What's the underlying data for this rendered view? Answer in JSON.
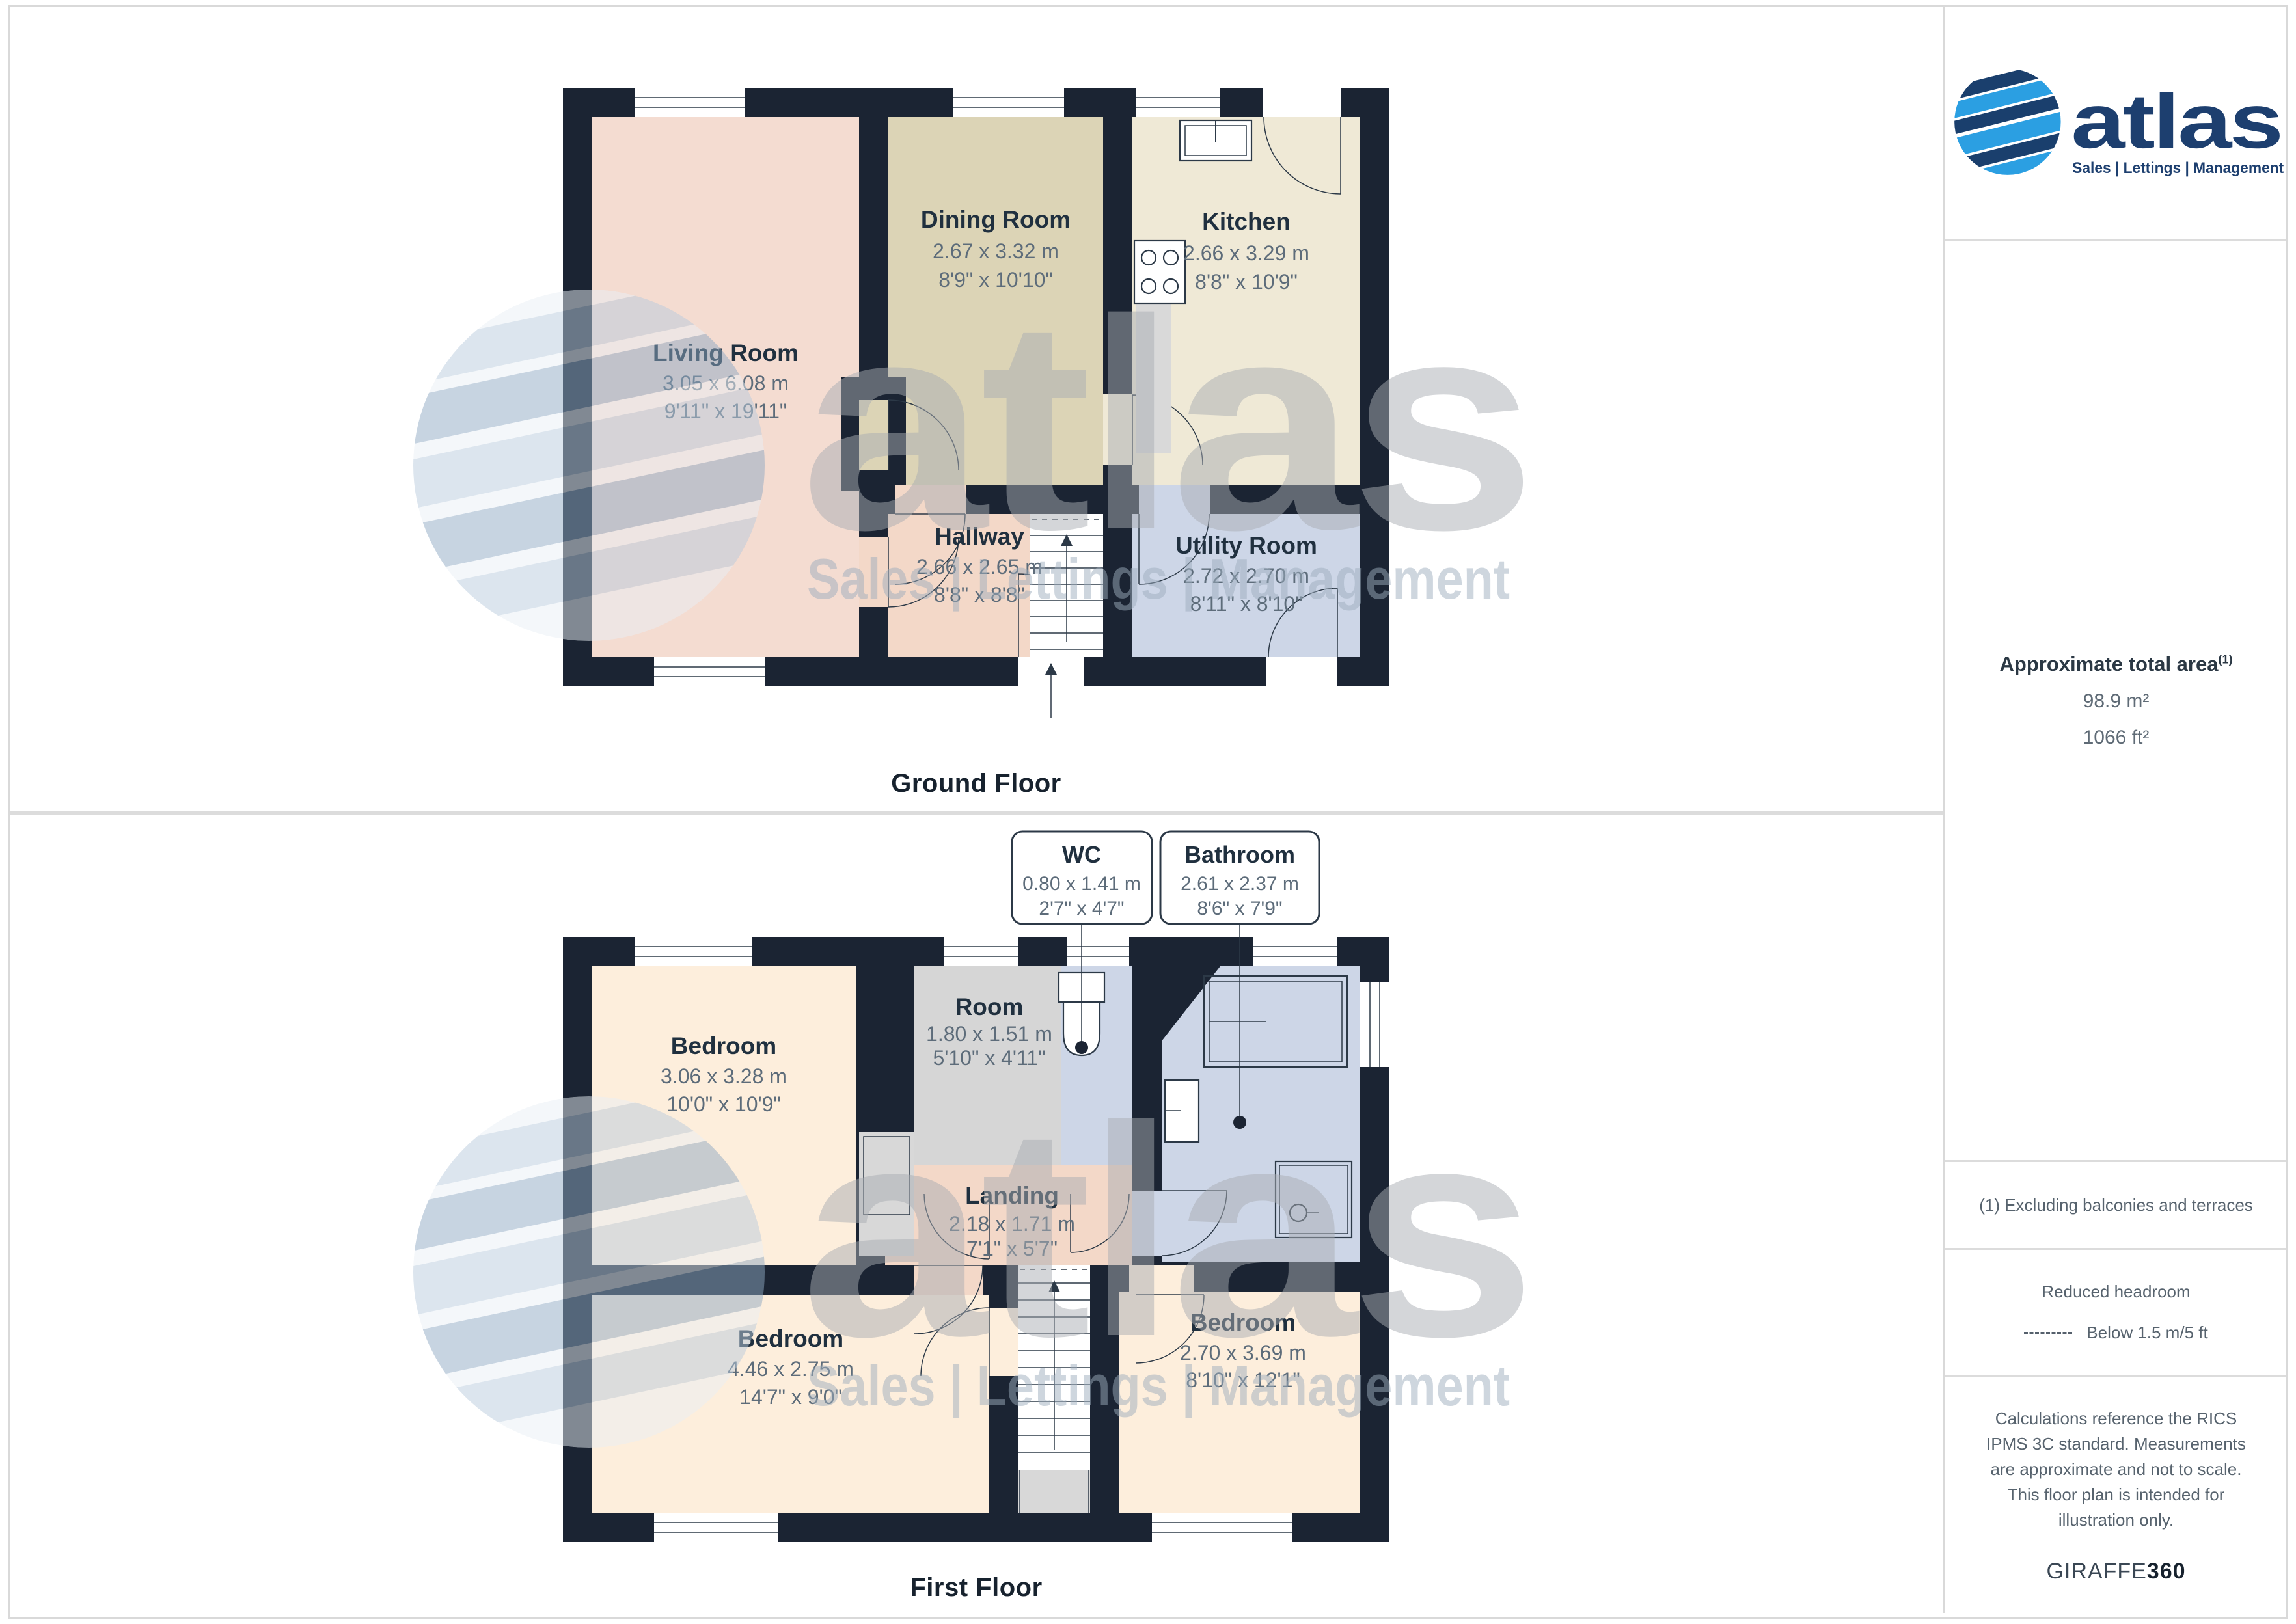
{
  "ground_floor": {
    "title": "Ground Floor",
    "rooms": {
      "living": {
        "name": "Living Room",
        "m": "3.05 x 6.08 m",
        "ft": "9'11\" x 19'11\""
      },
      "dining": {
        "name": "Dining Room",
        "m": "2.67 x 3.32 m",
        "ft": "8'9\" x 10'10\""
      },
      "kitchen": {
        "name": "Kitchen",
        "m": "2.66 x 3.29 m",
        "ft": "8'8\" x 10'9\""
      },
      "hallway": {
        "name": "Hallway",
        "m": "2.66 x 2.65 m",
        "ft": "8'8\" x 8'8\""
      },
      "utility": {
        "name": "Utility Room",
        "m": "2.72 x 2.70 m",
        "ft": "8'11\" x 8'10\""
      }
    }
  },
  "first_floor": {
    "title": "First Floor",
    "rooms": {
      "bedroom1": {
        "name": "Bedroom",
        "m": "3.06 x 3.28 m",
        "ft": "10'0\" x 10'9\""
      },
      "room": {
        "name": "Room",
        "m": "1.80 x 1.51 m",
        "ft": "5'10\" x 4'11\""
      },
      "wc": {
        "name": "WC",
        "m": "0.80 x 1.41 m",
        "ft": "2'7\" x 4'7\""
      },
      "bathroom": {
        "name": "Bathroom",
        "m": "2.61 x 2.37 m",
        "ft": "8'6\" x 7'9\""
      },
      "landing": {
        "name": "Landing",
        "m": "2.18 x 1.71 m",
        "ft": "7'1\" x 5'7\""
      },
      "bedroom2": {
        "name": "Bedroom",
        "m": "4.46 x 2.75 m",
        "ft": "14'7\" x 9'0\""
      },
      "bedroom3": {
        "name": "Bedroom",
        "m": "2.70 x 3.69 m",
        "ft": "8'10\" x 12'1\""
      }
    }
  },
  "sidebar": {
    "brand": "atlas",
    "tagline": "Sales | Lettings | Management",
    "area_title": "Approximate total area",
    "footnote_marker": "(1)",
    "area_m2": "98.9 m²",
    "area_ft2": "1066 ft²",
    "footnote": "(1) Excluding balconies and terraces",
    "headroom_title": "Reduced headroom",
    "headroom_legend": "Below 1.5 m/5 ft",
    "disclaimer": "Calculations reference the RICS IPMS 3C standard. Measurements are approximate and not to scale. This floor plan is intended for illustration only.",
    "brand_footer_normal": "GIRAFFE",
    "brand_footer_bold": "360"
  },
  "watermark": {
    "brand": "atlas",
    "tagline": "Sales | Lettings | Management"
  },
  "colors": {
    "wall": "#1b2433",
    "living_pink": "#f4dcd1",
    "hall_pink": "#f3d8c8",
    "dining_tan": "#dcd4b6",
    "kitchen_cream": "#efe9d6",
    "utility_blue": "#cdd6e7",
    "bedroom_peach": "#fdeedc",
    "room_gray": "#d6d6d6",
    "brand_navy": "#1d3f6f",
    "brand_blue": "#2b9fe2"
  }
}
